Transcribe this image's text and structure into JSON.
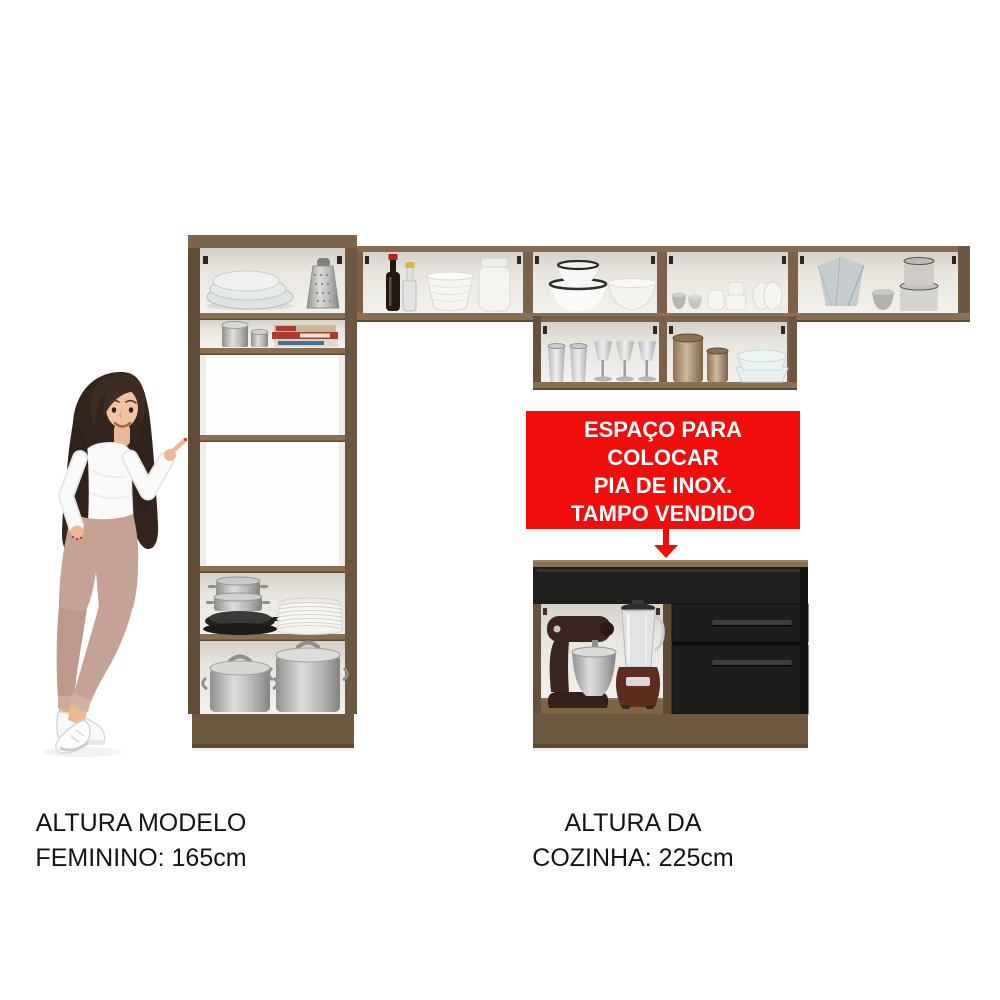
{
  "page": {
    "background": "#ffffff",
    "kind": "kitchen-set product image"
  },
  "banner": {
    "lines": [
      "ESPAÇO PARA COLOCAR",
      "PIA DE INOX.",
      "TAMPO VENDIDO",
      "SEPARADAMENTE."
    ],
    "bg_color": "#f20d0d",
    "text_color": "#ffffff",
    "arrow_icon": "down-arrow-icon"
  },
  "captions": {
    "model_height": {
      "lines": [
        "ALTURA MODELO",
        "FEMININO: 165cm"
      ]
    },
    "kitchen_height": {
      "lines": [
        "ALTURA DA",
        "COZINHA: 225cm"
      ]
    }
  },
  "colors": {
    "wood": "#7a6147",
    "wood_dark": "#5f4a34",
    "wood_light": "#8a7051",
    "cabinet_black": "#1d1d1b",
    "interior_white": "#edebe6",
    "accent_red": "#f20d0d",
    "text": "#141414"
  },
  "scene": {
    "model": "female model pointing at kitchen set",
    "units": [
      "tall-cabinet",
      "upper-cabinets-row1",
      "upper-cabinets-row2",
      "sink-base-cabinet"
    ]
  }
}
